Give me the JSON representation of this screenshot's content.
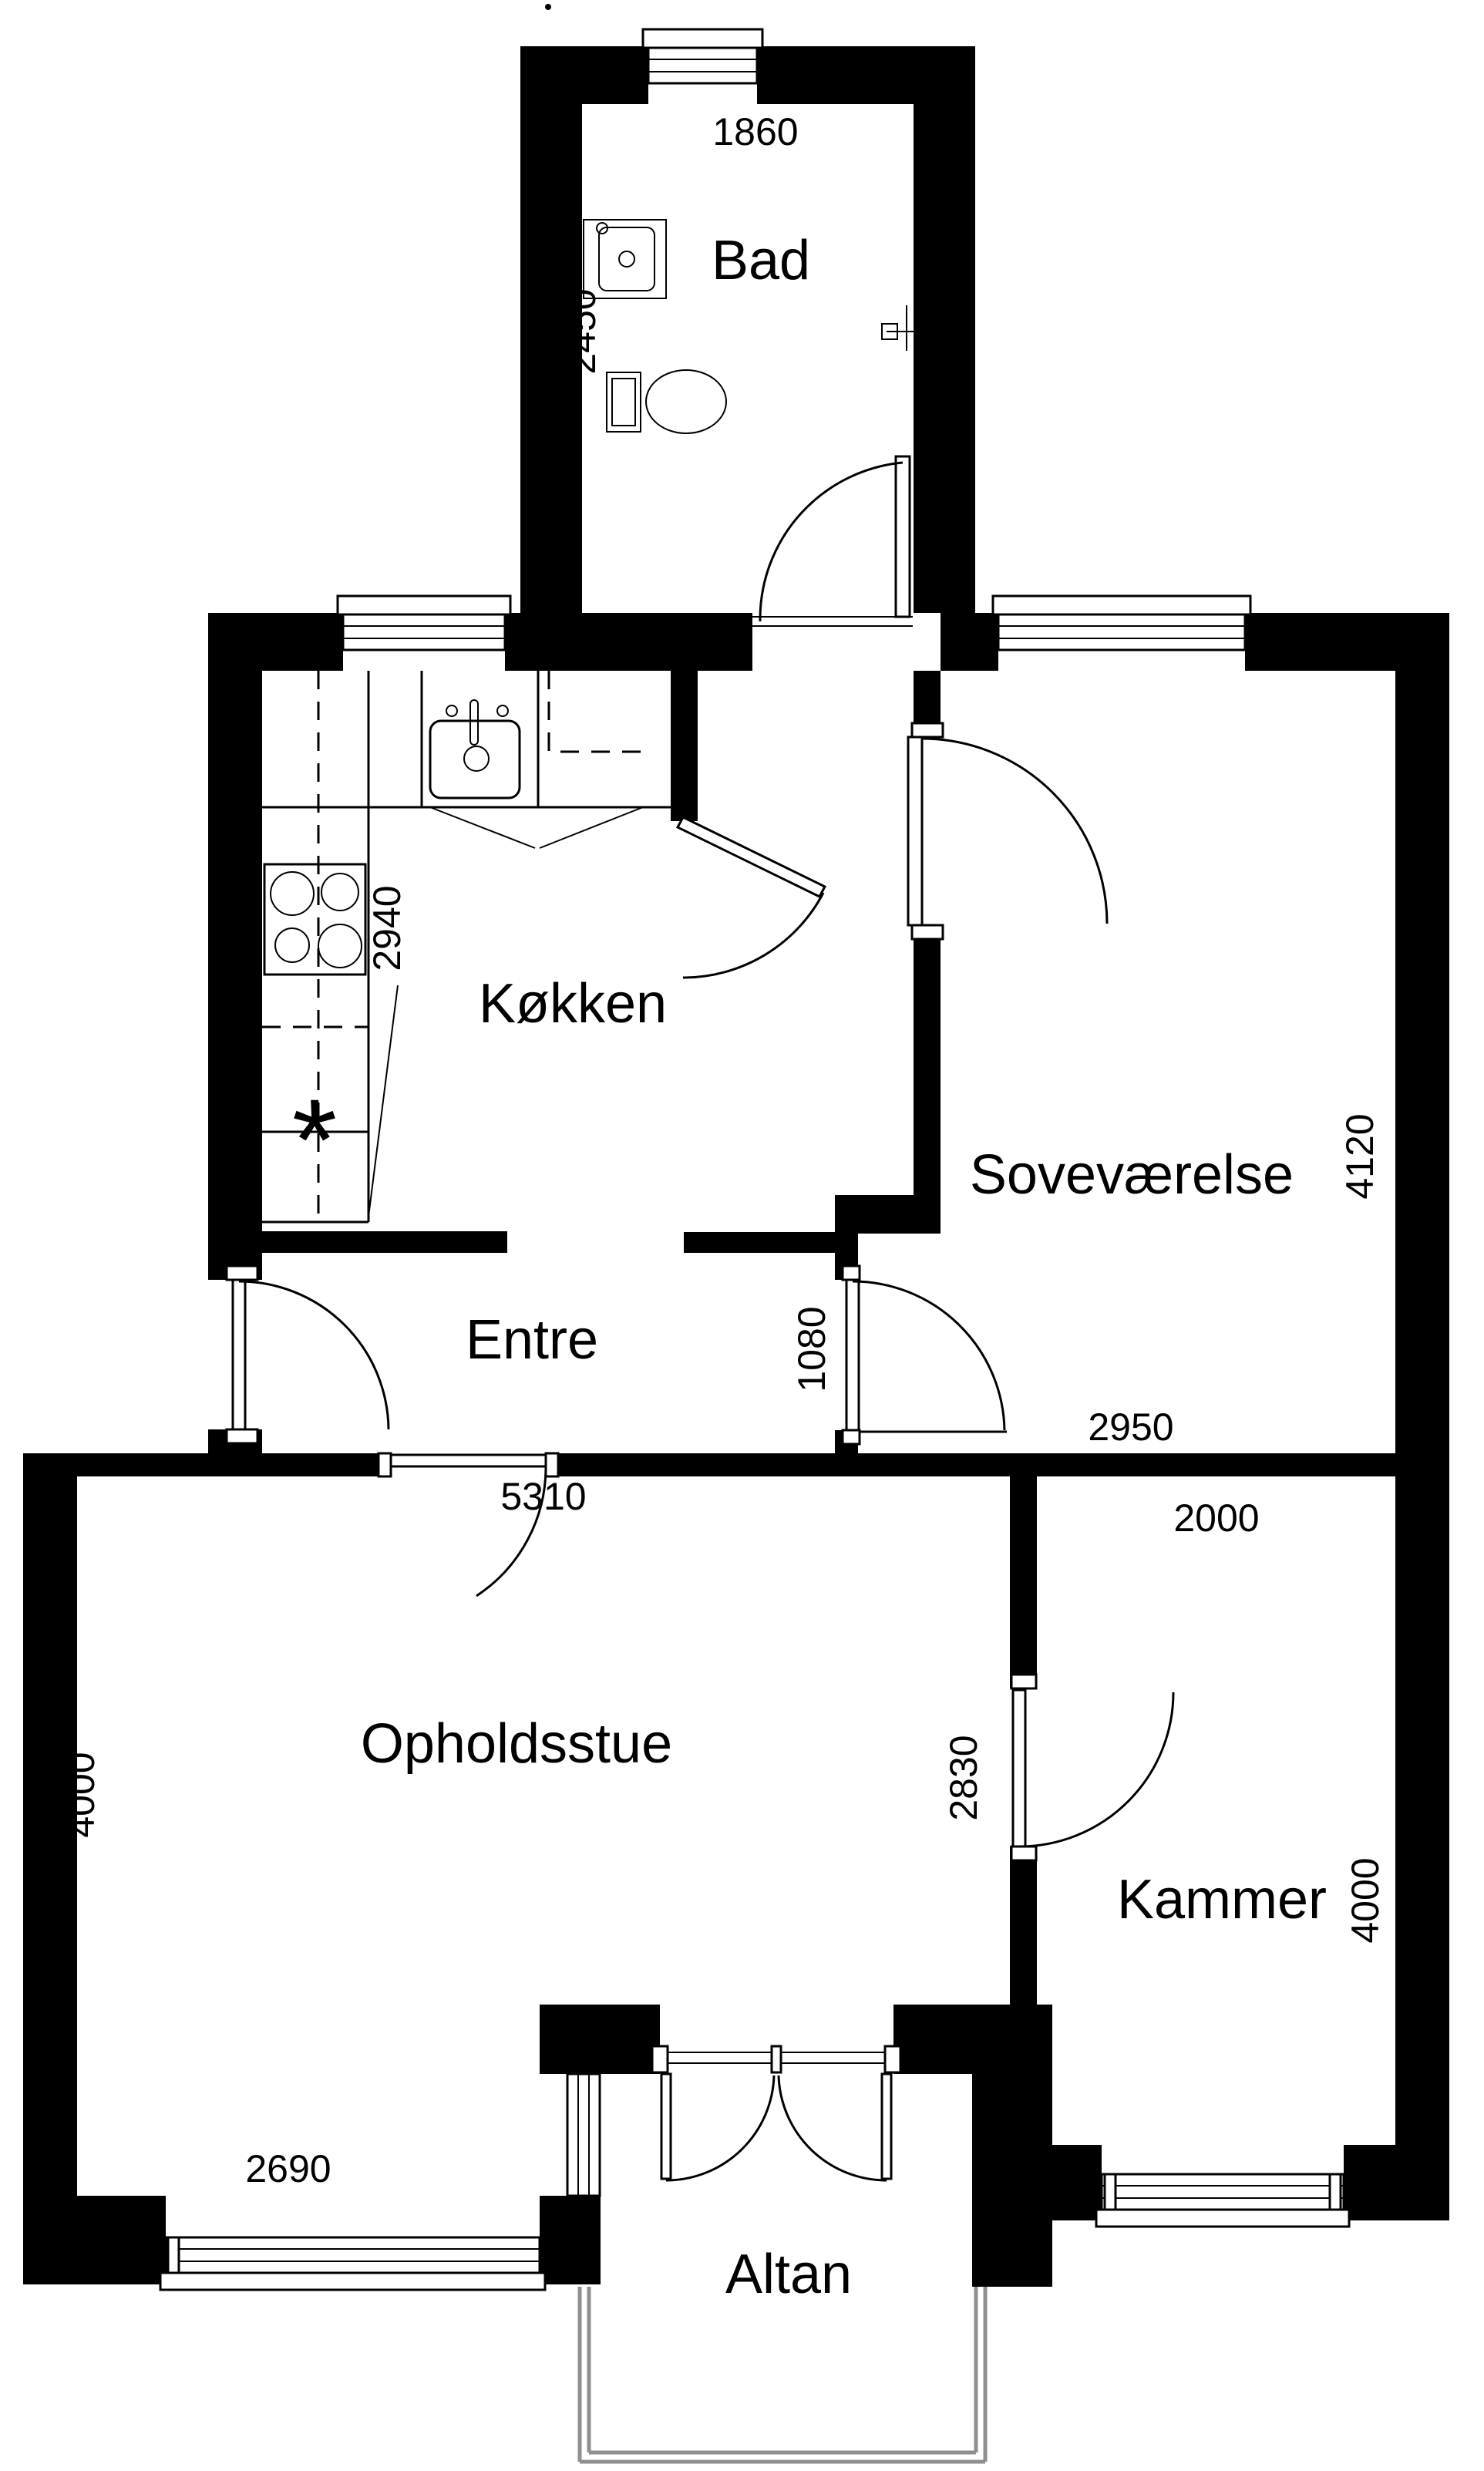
{
  "labels": {
    "bad": "Bad",
    "kitchen": "Køkken",
    "bedroom": "Soveværelse",
    "entry": "Entre",
    "living": "Opholdsstue",
    "chamber": "Kammer",
    "balcony": "Altan"
  },
  "dims": {
    "bad_width": "1860",
    "bad_depth": "2450",
    "kitchen_depth": "2940",
    "bedroom_depth": "4120",
    "entry_width": "1080",
    "bedroom_width": "2950",
    "living_width": "5310",
    "chamber_width": "2000",
    "chamber_door": "2830",
    "living_depth": "4000",
    "chamber_depth": "4000",
    "living_window": "2690"
  },
  "symbols": {
    "freezer_mark": "*"
  },
  "colors": {
    "wall": "#000000",
    "line": "#000000",
    "balcony_rail": "#8f8f8f",
    "background": "#ffffff"
  }
}
